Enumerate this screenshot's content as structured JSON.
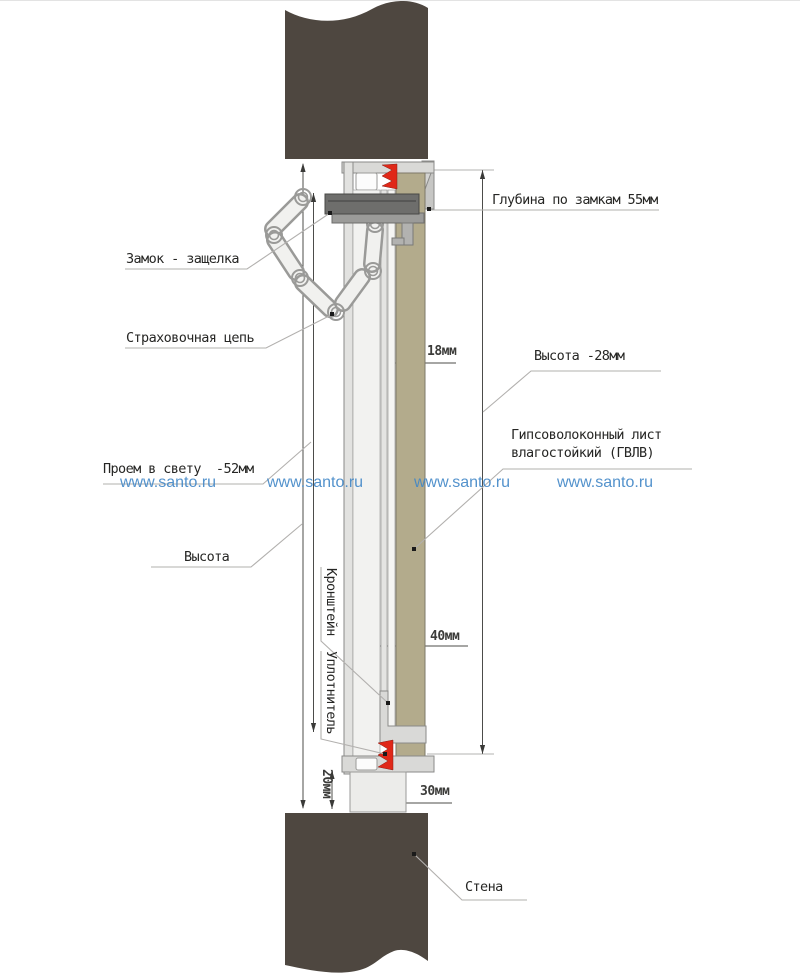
{
  "drawing": {
    "callouts": {
      "depth_locks": "Глубина по замкам 55мм",
      "lock_latch": "Замок - защелка",
      "safety_chain": "Страховочная цепь",
      "height_right": "Высота -28мм",
      "gvl": "Гипсоволоконный лист влагостойкий (ГВЛВ)",
      "clear_opening": "Проем в свету  -52мм",
      "height_left": "Высота",
      "bracket": "Кронштейн",
      "seal": "Уплотнитель",
      "wall": "Стена"
    },
    "dimensions": {
      "panel_thickness": "18мм",
      "frame_depth": "40мм",
      "bottom_width": "30мм",
      "bottom_gap": "20мм"
    },
    "colors": {
      "wall": "#4e4740",
      "gvl_panel": "#b3ab8c",
      "seal_red": "#e02818",
      "profile_light": "#dedede",
      "lock_dark": "#6e6e6c"
    }
  },
  "watermark": {
    "text": "www.santo.ru",
    "color": "#4187c7"
  }
}
